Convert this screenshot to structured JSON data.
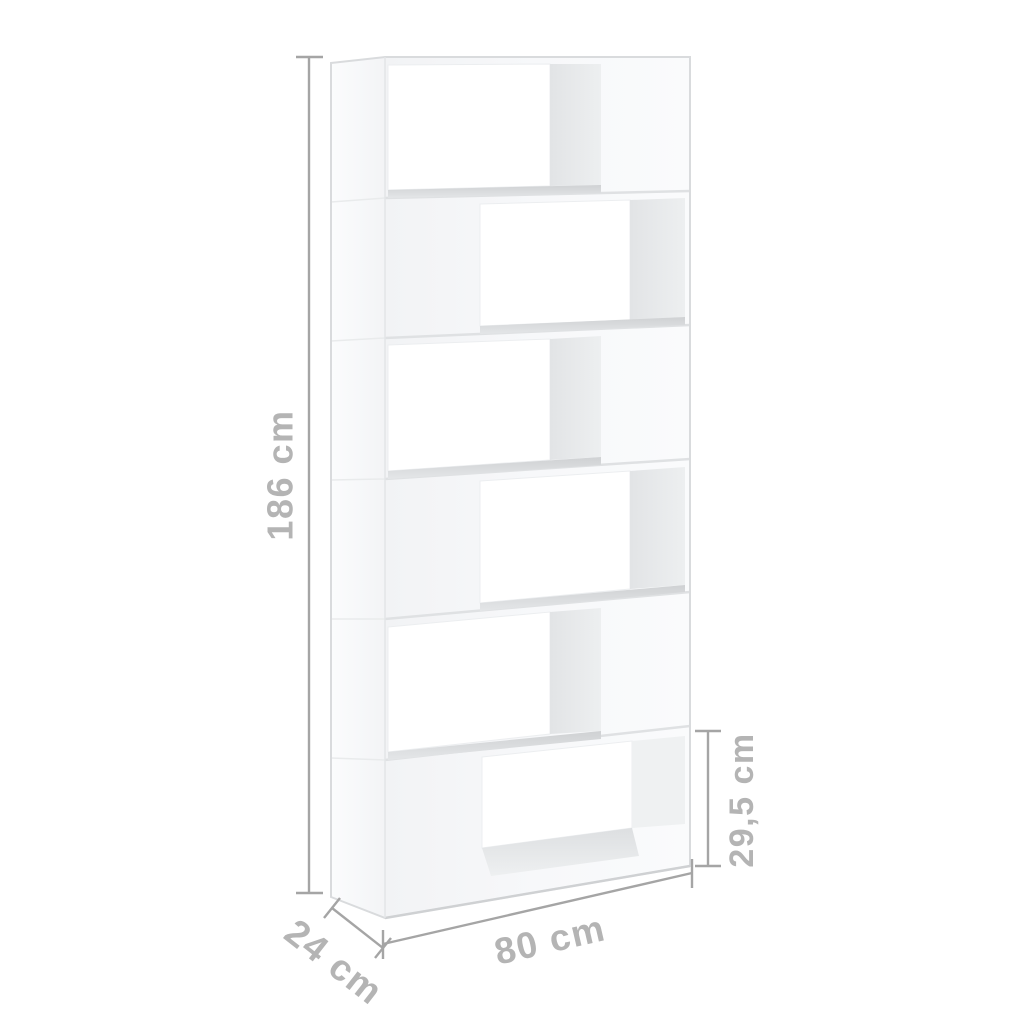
{
  "diagram": {
    "type": "product-dimension-diagram",
    "subject": "book cabinet room divider, white, 6 staggered compartments"
  },
  "dimensions": {
    "height": "186 cm",
    "width": "80 cm",
    "depth": "24 cm",
    "compartment_height": "29,5 cm"
  },
  "bookcase": {
    "rows": "6",
    "color": "white"
  },
  "colors": {
    "background": "#ffffff",
    "dimension_line": "#a5a5a5",
    "dimension_text": "#b4b4b4",
    "panel_light": "#f4f5f7",
    "interior_shadow": "#e5e7e9",
    "shelf_shadow": "#d3d5d7"
  }
}
